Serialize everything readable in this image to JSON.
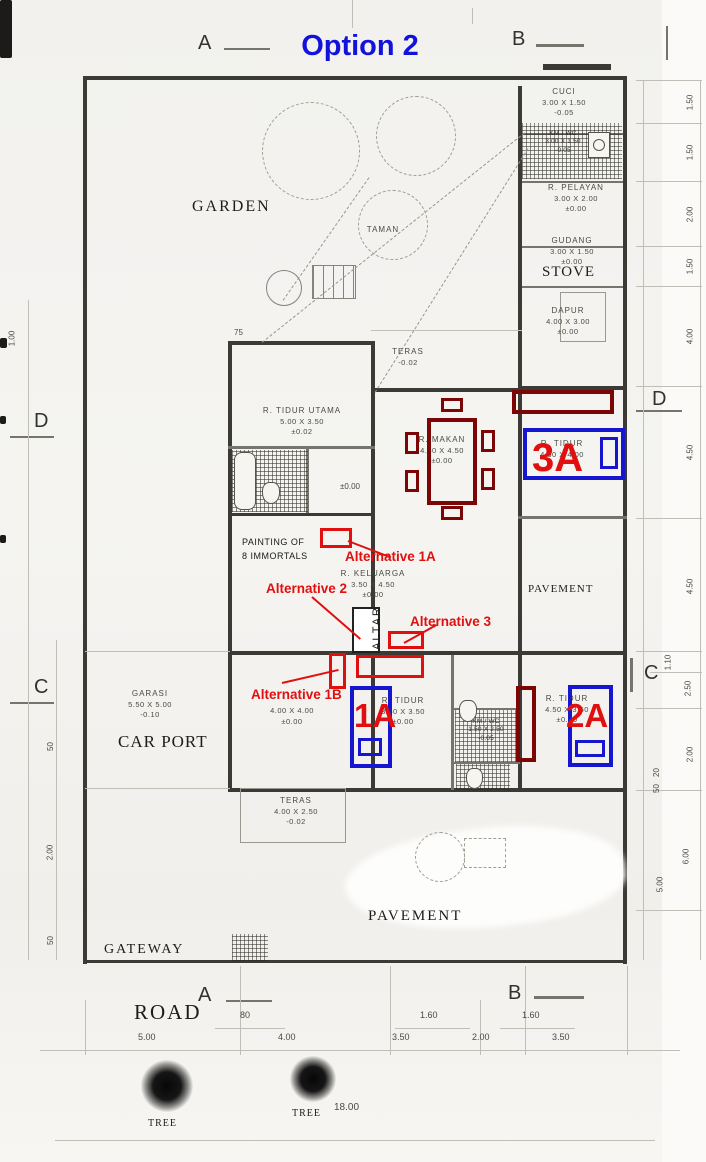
{
  "title": "Option 2",
  "grid": {
    "a": "A",
    "b": "B",
    "c": "C",
    "d": "D"
  },
  "rooms": {
    "cuci": {
      "name": "CUCI",
      "dims": "3.00 X 1.50",
      "level": "-0.05"
    },
    "kmwc_top": {
      "name": "KM / WC",
      "dims": "3.00 X 1.50",
      "level": "-0.05"
    },
    "pelayan": {
      "name": "R. PELAYAN",
      "dims": "3.00 X 2.00",
      "level": "±0.00"
    },
    "gudang": {
      "name": "GUDANG",
      "dims": "3.00 X 1.50",
      "level": "±0.00"
    },
    "stove": {
      "name": "STOVE"
    },
    "dapur": {
      "name": "DAPUR",
      "dims": "4.00 X 3.00",
      "level": "±0.00"
    },
    "teras_atas": {
      "name": "TERAS",
      "level": "-0.02"
    },
    "tidur_utama": {
      "name": "R. TIDUR UTAMA",
      "dims": "5.00 X 3.50",
      "level": "±0.02"
    },
    "makan": {
      "name": "R. MAKAN",
      "dims": "4.50 X 4.50",
      "level": "±0.00"
    },
    "tidur_3a": {
      "name": "R. TIDUR",
      "dims": "4.50 X 4.00",
      "level": "±0.00"
    },
    "pavement_tengah": {
      "name": "PAVEMENT"
    },
    "keluarga": {
      "name": "R. KELUARGA",
      "dims": "3.50 X 4.50",
      "level": "±0.00"
    },
    "altar": {
      "name": "ALTAR"
    },
    "garasi": {
      "name": "GARASI",
      "dims": "5.50 X 5.00",
      "level": "-0.10"
    },
    "carport": {
      "name": "CAR PORT"
    },
    "ruang_4x4": {
      "dims": "4.00 X 4.00",
      "level": "±0.00"
    },
    "tidur_1a": {
      "name": "R. TIDUR",
      "dims": "3.50 X 3.50",
      "level": "±0.00"
    },
    "kmwc_tengah": {
      "name": "KM / WC",
      "dims": "1.50 X 2.50",
      "level": "-0.05"
    },
    "tidur_2a": {
      "name": "R. TIDUR",
      "dims": "4.50 X 3.50",
      "level": "±0.00"
    },
    "teras_bawah": {
      "name": "TERAS",
      "dims": "4.00 X 2.50",
      "level": "-0.02"
    },
    "pavement_bawah": {
      "name": "PAVEMENT"
    },
    "garden": {
      "name": "GARDEN"
    },
    "taman": {
      "name": "TAMAN"
    },
    "gateway": {
      "name": "GATEWAY"
    },
    "road": {
      "name": "ROAD"
    },
    "painting": {
      "line1": "PAINTING OF",
      "line2": "8 IMMORTALS"
    },
    "hall_level": "±0.00"
  },
  "annotations": {
    "alt_1a": "Alternative 1A",
    "alt_2": "Alternative 2",
    "alt_3": "Alternative 3",
    "alt_1b": "Alternative 1B",
    "bed_1a": "1A",
    "bed_2a": "2A",
    "bed_3a": "3A"
  },
  "dimensions": {
    "right": [
      "1.50",
      "1.50",
      "2.00",
      "1.50",
      "4.00",
      "4.50",
      "4.50",
      "1.10",
      "2.50",
      "2.00",
      "20",
      "50",
      "6.00",
      "5.00"
    ],
    "left": [
      "1.00",
      "50",
      "2.00",
      "50"
    ],
    "bottom": [
      "5.00",
      "80",
      "4.00",
      "1.60",
      "3.50",
      "2.00",
      "1.60",
      "3.50"
    ],
    "total_width": "18.00",
    "offset": "75"
  },
  "trees": {
    "label": "TREE"
  },
  "colors": {
    "annotation_red": "#e01010",
    "bed_blue": "#1616d0",
    "furniture_maroon": "#7c0606",
    "title_blue": "#1212dd",
    "wall": "#3b3a35"
  }
}
